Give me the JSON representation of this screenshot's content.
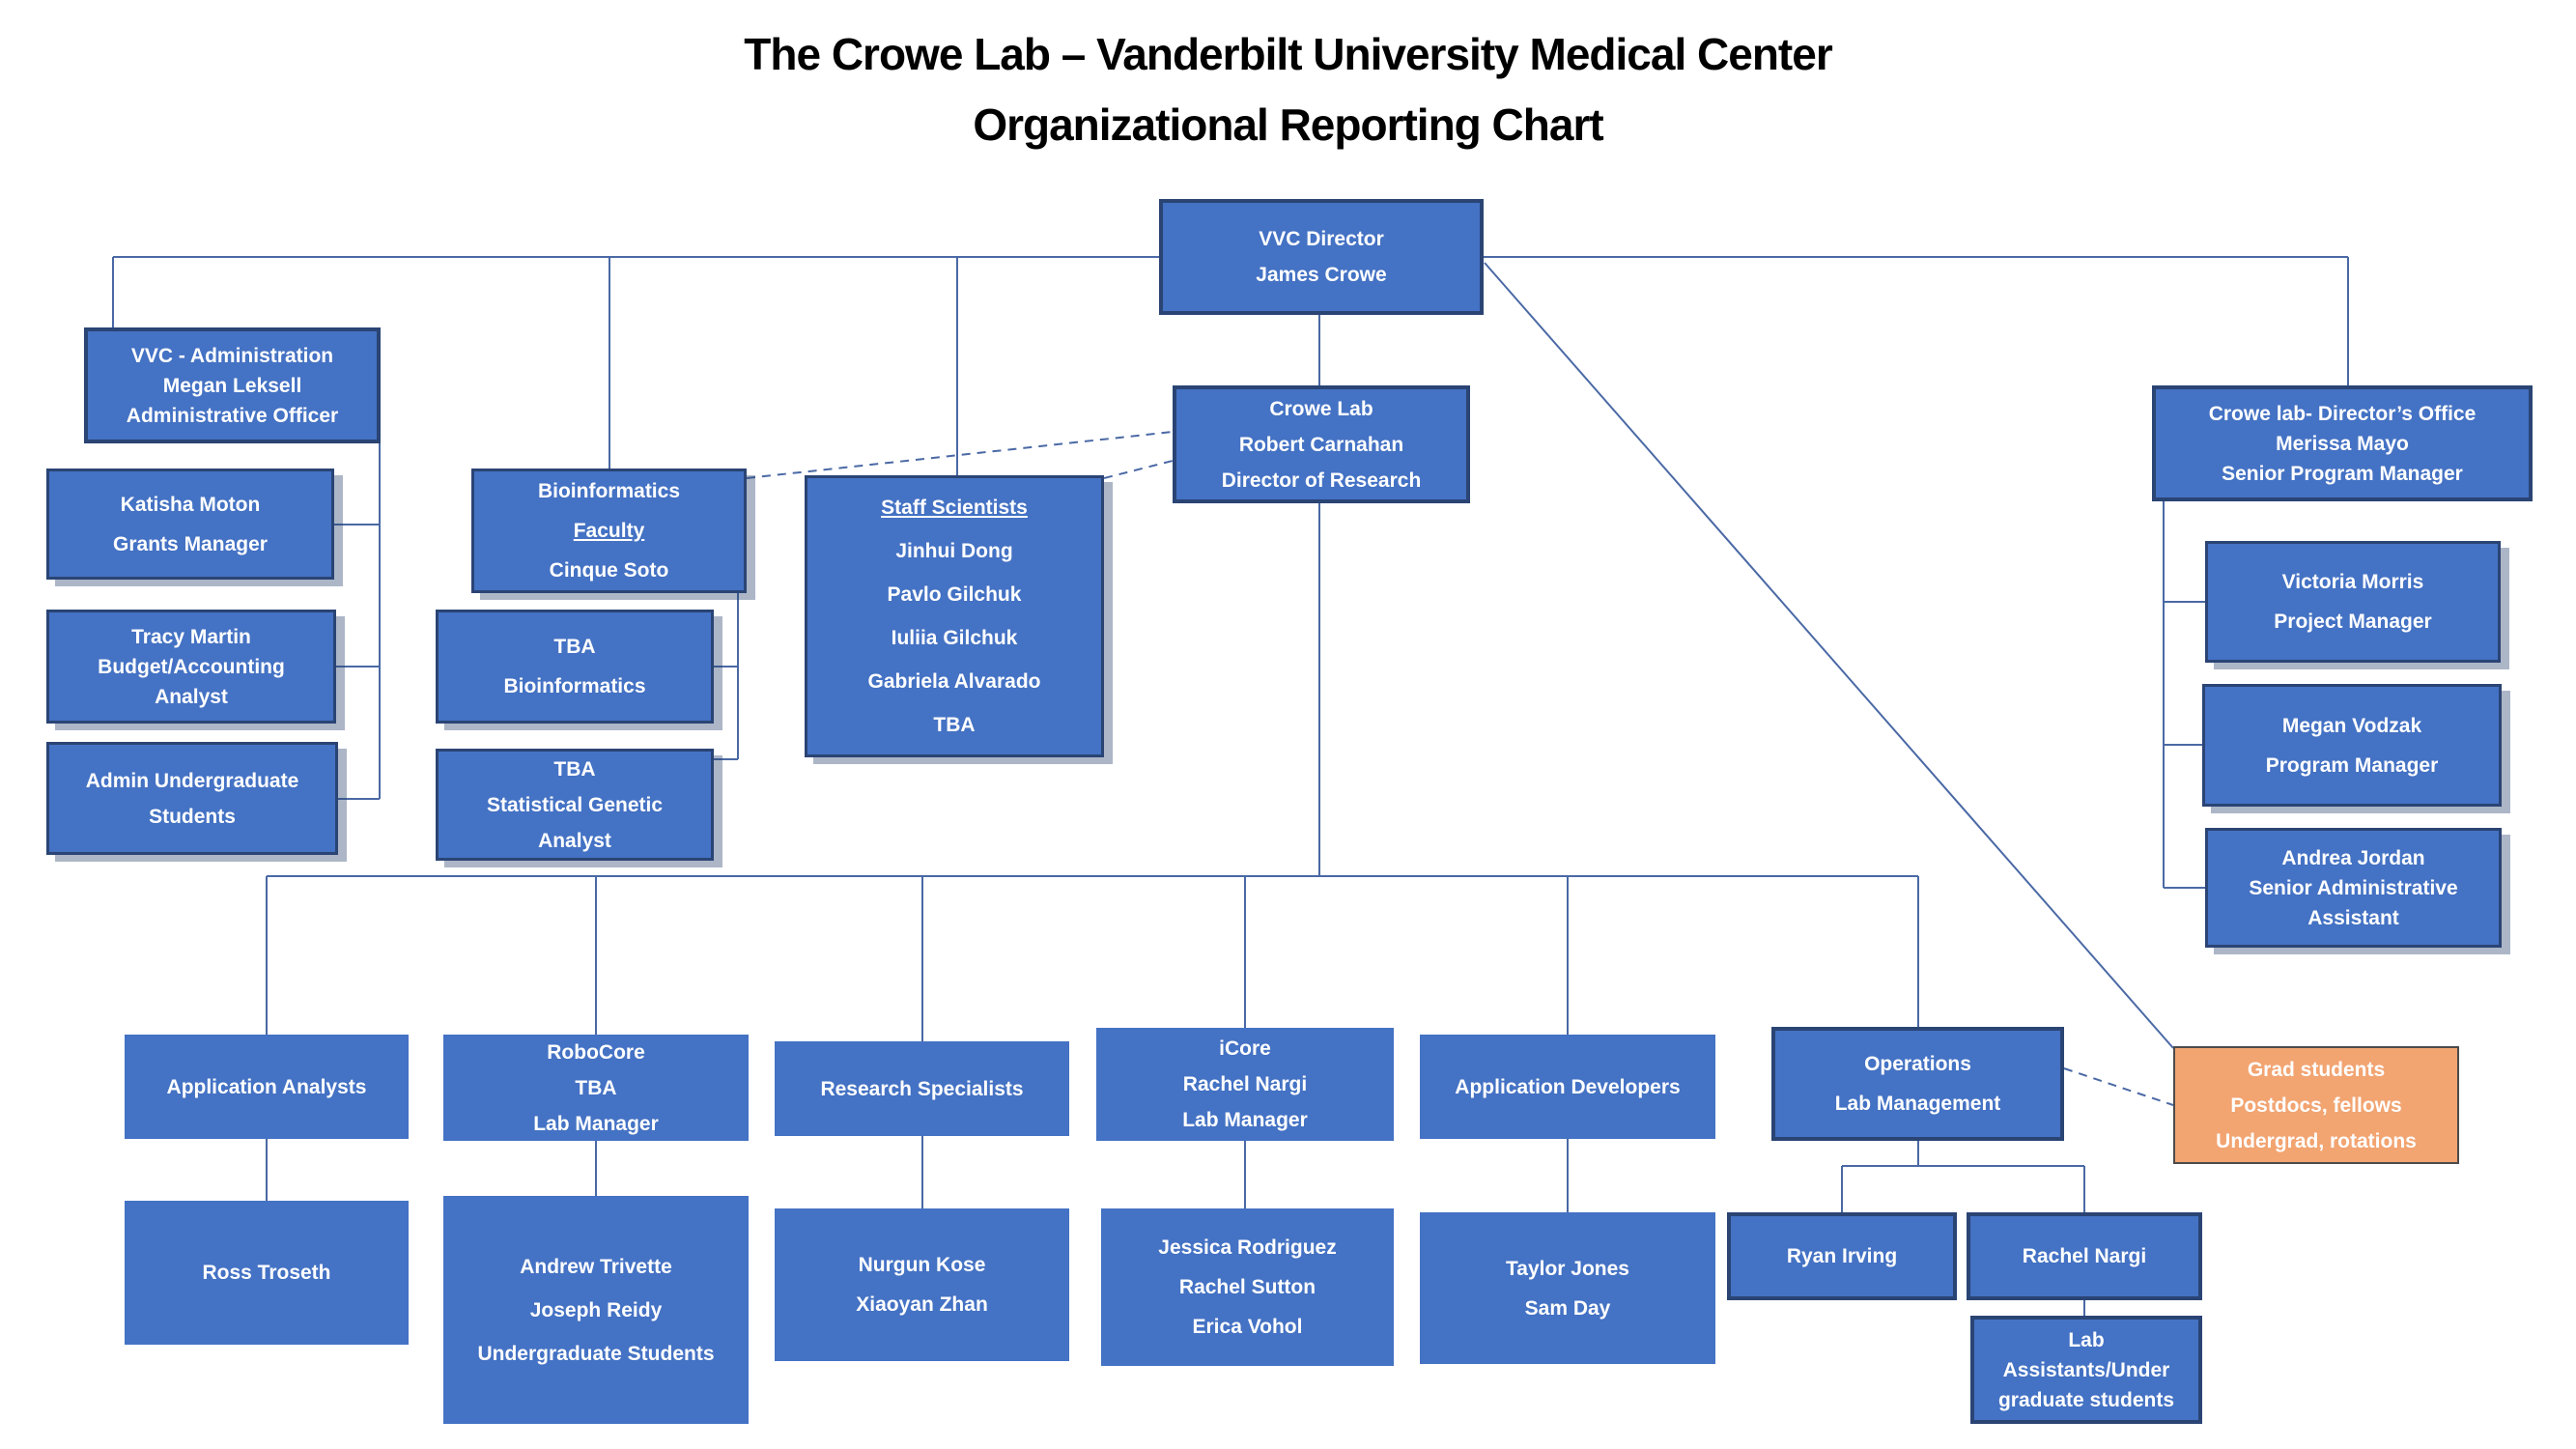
{
  "title": {
    "line1": "The Crowe Lab – Vanderbilt University Medical Center",
    "line2": "Organizational Reporting Chart"
  },
  "colors": {
    "box_blue": "#4472C4",
    "box_border": "#2A4474",
    "box_orange": "#F2A471",
    "connector_line": "#4A69A5",
    "box_text": "#FFFFFF",
    "title_text": "#000000"
  },
  "nodes": {
    "vvc_director": {
      "lines": [
        "VVC Director",
        "James Crowe"
      ]
    },
    "vvc_admin": {
      "lines": [
        "VVC - Administration",
        "Megan Leksell",
        "Administrative Officer"
      ]
    },
    "katisha": {
      "lines": [
        "Katisha Moton",
        "Grants Manager"
      ]
    },
    "tracy": {
      "lines": [
        "Tracy Martin",
        "Budget/Accounting",
        "Analyst"
      ]
    },
    "admin_undergrad": {
      "lines": [
        "Admin Undergraduate",
        "Students"
      ]
    },
    "bioinformatics": {
      "lines": [
        "Bioinformatics",
        "Faculty",
        "Cinque Soto"
      ]
    },
    "tba_bio": {
      "lines": [
        "TBA",
        "Bioinformatics"
      ]
    },
    "tba_stat": {
      "lines": [
        "TBA",
        "Statistical Genetic",
        "Analyst"
      ]
    },
    "staff_scientists": {
      "lines": [
        "Staff Scientists",
        "Jinhui Dong",
        "Pavlo Gilchuk",
        "Iuliia Gilchuk",
        "Gabriela Alvarado",
        "TBA"
      ]
    },
    "crowe_lab": {
      "lines": [
        "Crowe Lab",
        "Robert Carnahan",
        "Director of Research"
      ]
    },
    "directors_office": {
      "lines": [
        "Crowe lab- Director’s Office",
        "Merissa Mayo",
        "Senior Program Manager"
      ]
    },
    "victoria": {
      "lines": [
        "Victoria Morris",
        "Project Manager"
      ]
    },
    "megan_vodzak": {
      "lines": [
        "Megan Vodzak",
        "Program Manager"
      ]
    },
    "andrea": {
      "lines": [
        "Andrea Jordan",
        "Senior Administrative",
        "Assistant"
      ]
    },
    "app_analysts": {
      "lines": [
        "Application Analysts"
      ]
    },
    "robocore": {
      "lines": [
        "RoboCore",
        "TBA",
        "Lab Manager"
      ]
    },
    "research_specialists": {
      "lines": [
        "Research Specialists"
      ]
    },
    "icore": {
      "lines": [
        "iCore",
        "Rachel Nargi",
        "Lab Manager"
      ]
    },
    "app_developers": {
      "lines": [
        "Application Developers"
      ]
    },
    "operations": {
      "lines": [
        "Operations",
        "Lab Management"
      ]
    },
    "grad_students": {
      "lines": [
        "Grad students",
        "Postdocs, fellows",
        "Undergrad, rotations"
      ]
    },
    "ross": {
      "lines": [
        "Ross Troseth"
      ]
    },
    "andrew": {
      "lines": [
        "Andrew Trivette",
        "Joseph Reidy",
        "Undergraduate Students"
      ]
    },
    "nurgun": {
      "lines": [
        "Nurgun Kose",
        "Xiaoyan Zhan"
      ]
    },
    "jessica": {
      "lines": [
        "Jessica Rodriguez",
        "Rachel Sutton",
        "Erica Vohol"
      ]
    },
    "taylor": {
      "lines": [
        "Taylor Jones",
        "Sam Day"
      ]
    },
    "ryan": {
      "lines": [
        "Ryan Irving"
      ]
    },
    "rachel_nargi": {
      "lines": [
        "Rachel Nargi"
      ]
    },
    "lab_assistants": {
      "lines": [
        "Lab",
        "Assistants/Under",
        "graduate students"
      ]
    }
  }
}
